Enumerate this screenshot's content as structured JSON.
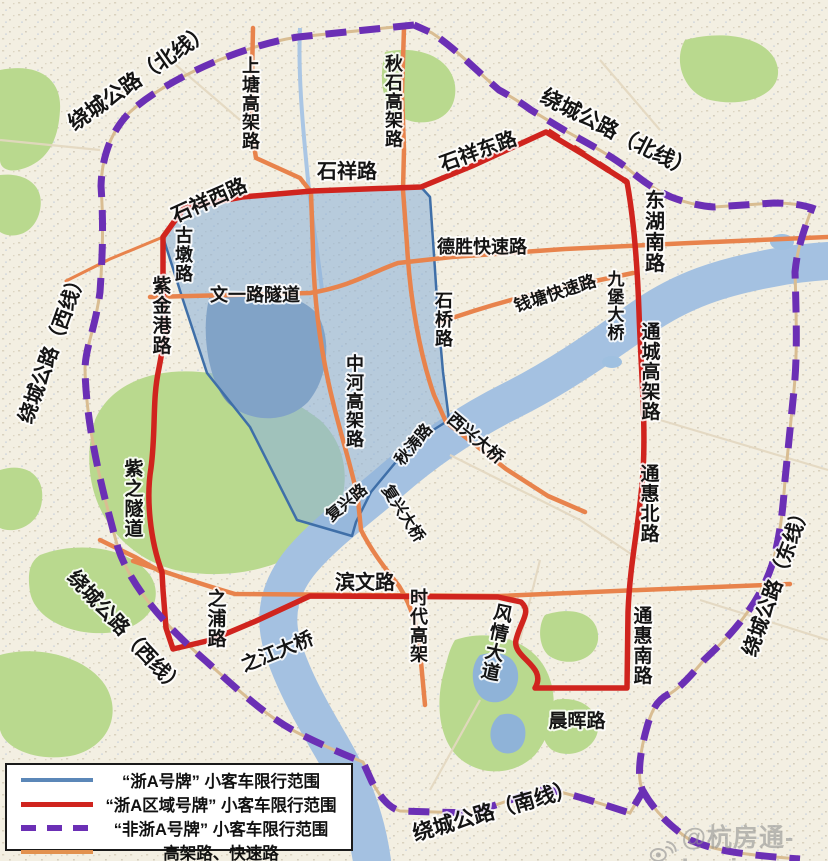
{
  "colors": {
    "zhea_plate_blue": "#5b87b8",
    "zhea_region_red": "#d0241e",
    "non_zhea_purple": "#6b2fb5",
    "elevated_orange": "#e2914e",
    "restricted_zone_fill": "#8fb2d9"
  },
  "legend": {
    "items": [
      {
        "label": "“浙A号牌” 小客车限行范围",
        "swatch": "blue-solid"
      },
      {
        "label": "“浙A区域号牌” 小客车限行范围",
        "swatch": "red-solid"
      },
      {
        "label": "“非浙A号牌” 小客车限行范围",
        "swatch": "purple-dashed"
      },
      {
        "label": "高架路、快速路",
        "swatch": "orange-solid"
      }
    ]
  },
  "watermark": {
    "handle": "@杭房通-Louis"
  },
  "map": {
    "labels": [
      {
        "id": "ring-north-west",
        "text": "绕城公路（北线）"
      },
      {
        "id": "ring-north-east",
        "text": "绕城公路（北线）"
      },
      {
        "id": "ring-west-upper",
        "text": "绕城公路（西线）"
      },
      {
        "id": "ring-west-lower",
        "text": "绕城公路（西线）"
      },
      {
        "id": "ring-east",
        "text": "绕城公路（东线）"
      },
      {
        "id": "ring-south",
        "text": "绕城公路（南线）"
      },
      {
        "id": "shangtang-viaduct",
        "text": "上塘高架路"
      },
      {
        "id": "qiushi-viaduct",
        "text": "秋石高架路"
      },
      {
        "id": "shixiang-rd",
        "text": "石祥路"
      },
      {
        "id": "shixiang-west-rd",
        "text": "石祥西路"
      },
      {
        "id": "shixiang-east-rd",
        "text": "石祥东路"
      },
      {
        "id": "gudun-rd",
        "text": "古墩路"
      },
      {
        "id": "wenyi-tunnel",
        "text": "文一路隧道"
      },
      {
        "id": "desheng-expwy",
        "text": "德胜快速路"
      },
      {
        "id": "qiantang-expwy",
        "text": "钱塘快速路"
      },
      {
        "id": "donghu-south-rd",
        "text": "东湖南路"
      },
      {
        "id": "jiubao-bridge",
        "text": "九堡大桥"
      },
      {
        "id": "zijingang-rd",
        "text": "紫金港路"
      },
      {
        "id": "zizhi-tunnel",
        "text": "紫之隧道"
      },
      {
        "id": "zhonghe-viaduct",
        "text": "中河高架路"
      },
      {
        "id": "shiqiao-rd",
        "text": "石桥路"
      },
      {
        "id": "xixing-bridge",
        "text": "西兴大桥"
      },
      {
        "id": "qiutao-rd",
        "text": "秋涛路"
      },
      {
        "id": "fuxing-rd",
        "text": "复兴路"
      },
      {
        "id": "fuxing-bridge",
        "text": "复兴大桥"
      },
      {
        "id": "binwen-rd",
        "text": "滨文路"
      },
      {
        "id": "shidai-viaduct",
        "text": "时代高架"
      },
      {
        "id": "zhipu-rd",
        "text": "之浦路"
      },
      {
        "id": "zhijiang-bridge",
        "text": "之江大桥"
      },
      {
        "id": "fengqing-ave",
        "text": "风情大道"
      },
      {
        "id": "tongcheng-viaduct",
        "text": "通城高架路"
      },
      {
        "id": "tonghui-north-rd",
        "text": "通惠北路"
      },
      {
        "id": "tonghui-south-rd",
        "text": "通惠南路"
      },
      {
        "id": "chenhui-rd",
        "text": "晨晖路"
      }
    ]
  }
}
